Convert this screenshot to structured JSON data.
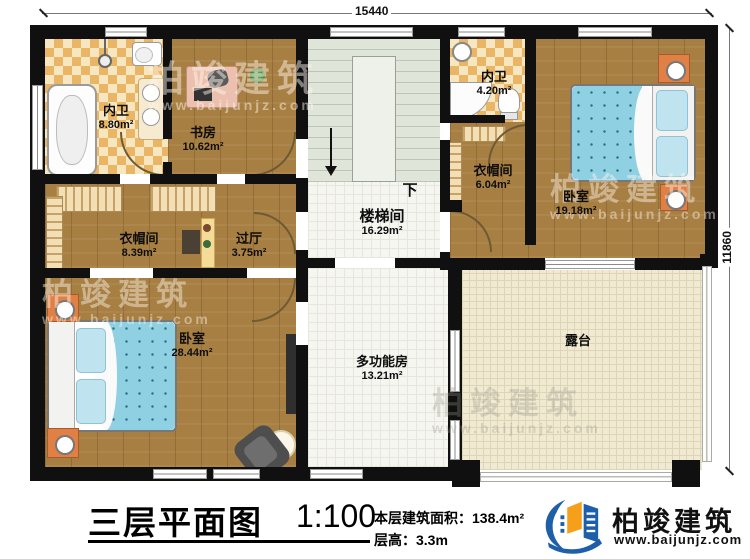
{
  "plan": {
    "dimension_top": "15440",
    "dimension_right": "11860",
    "stairs_down_label": "下",
    "rooms": {
      "bath_master": {
        "name": "内卫",
        "area": "8.80m²"
      },
      "study": {
        "name": "书房",
        "area": "10.62m²"
      },
      "stairwell": {
        "name": "楼梯间",
        "area": "16.29m²"
      },
      "bath_second": {
        "name": "内卫",
        "area": "4.20m²"
      },
      "cloak_small": {
        "name": "衣帽间",
        "area": "6.04m²"
      },
      "bedroom_right": {
        "name": "卧室",
        "area": "19.18m²"
      },
      "cloak_large": {
        "name": "衣帽间",
        "area": "8.39m²"
      },
      "hallway": {
        "name": "过厅",
        "area": "3.75m²"
      },
      "bedroom_main": {
        "name": "卧室",
        "area": "28.44m²"
      },
      "multi_room": {
        "name": "多功能房",
        "area": "13.21m²"
      },
      "terrace": {
        "name": "露台",
        "area": ""
      }
    }
  },
  "titlebar": {
    "title": "三层平面图",
    "scale": "1:100",
    "area_label": "本层建筑面积：",
    "area_value": "138.4m²",
    "height_label": "层高：",
    "height_value": "3.3m"
  },
  "watermark": {
    "brand": "柏竣建筑",
    "url": "www.baijunjz.com"
  },
  "logo": {
    "brand": "柏竣建筑",
    "url": "www.baijunjz.com"
  },
  "colors": {
    "wall": "#101010",
    "wood": "#a87f42",
    "tile_accent": "#eab564",
    "bed": "#8fd0e2",
    "nightstand": "#e08045",
    "logo_blue": "#1d5fa8",
    "logo_orange": "#f59f1b"
  }
}
